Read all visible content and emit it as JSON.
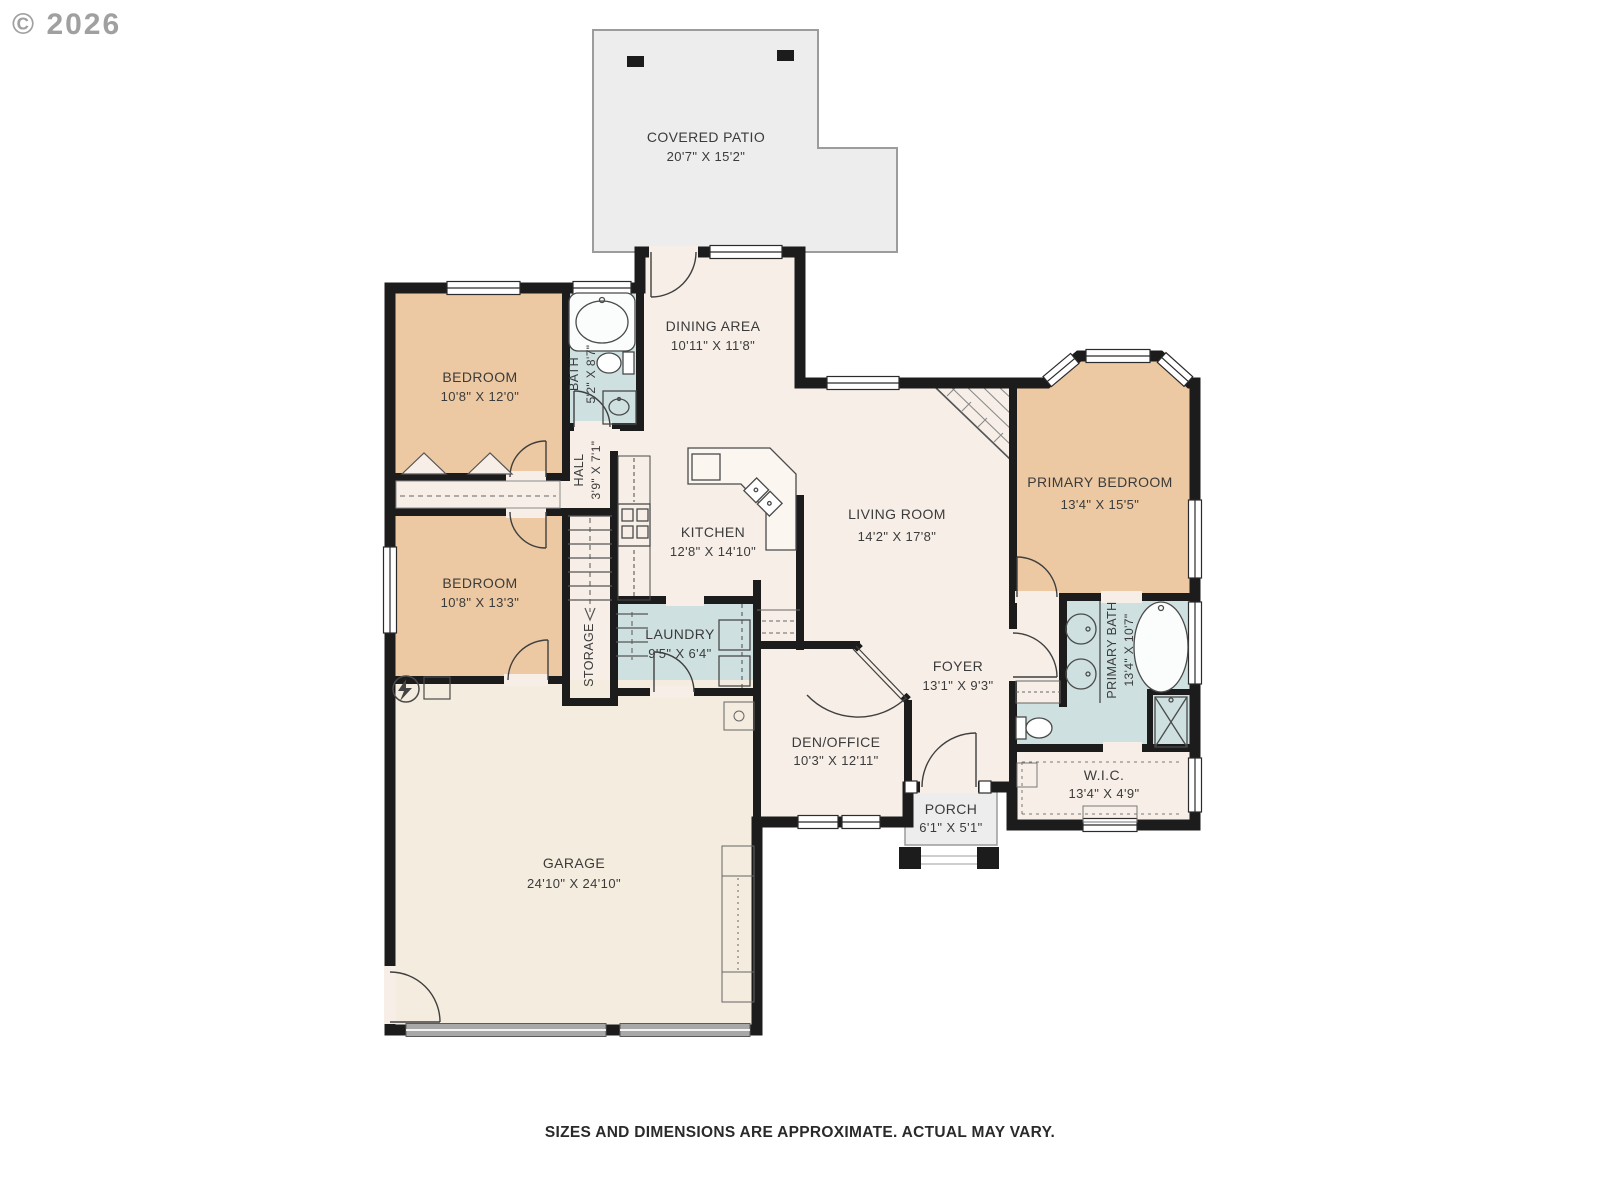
{
  "copyright": "© 2026",
  "disclaimer": "SIZES AND DIMENSIONS ARE APPROXIMATE. ACTUAL MAY VARY.",
  "palette": {
    "wall": "#1c1c1c",
    "floor_cream": "#f7efe7",
    "bedroom_tan": "#ecc9a2",
    "bath_blue": "#cfe0e1",
    "garage_cream": "#f4ecdf",
    "patio_gray": "#ededed",
    "label_text": "#3b3b3b"
  },
  "rooms": {
    "patio": {
      "name": "COVERED PATIO",
      "dims": "20'7\" X 15'2\""
    },
    "bedroom_top": {
      "name": "BEDROOM",
      "dims": "10'8\" X 12'0\""
    },
    "bath": {
      "name": "BATH",
      "dims": "5'2\" X 8'7\""
    },
    "hall": {
      "name": "HALL",
      "dims": "3'9\" X 7'1\""
    },
    "dining": {
      "name": "DINING AREA",
      "dims": "10'11\" X 11'8\""
    },
    "kitchen": {
      "name": "KITCHEN",
      "dims": "12'8\" X 14'10\""
    },
    "bedroom_bottom": {
      "name": "BEDROOM",
      "dims": "10'8\" X 13'3\""
    },
    "storage": {
      "name": "STORAGE"
    },
    "laundry": {
      "name": "LAUNDRY",
      "dims": "9'5\" X 6'4\""
    },
    "living": {
      "name": "LIVING ROOM",
      "dims": "14'2\" X 17'8\""
    },
    "primary_bedroom": {
      "name": "PRIMARY BEDROOM",
      "dims": "13'4\" X 15'5\""
    },
    "primary_bath": {
      "name": "PRIMARY BATH",
      "dims": "13'4\" X 10'7\""
    },
    "foyer": {
      "name": "FOYER",
      "dims": "13'1\" X 9'3\""
    },
    "den": {
      "name": "DEN/OFFICE",
      "dims": "10'3\" X 12'11\""
    },
    "wic": {
      "name": "W.I.C.",
      "dims": "13'4\" X 4'9\""
    },
    "porch": {
      "name": "PORCH",
      "dims": "6'1\" X 5'1\""
    },
    "garage": {
      "name": "GARAGE",
      "dims": "24'10\" X 24'10\""
    }
  }
}
